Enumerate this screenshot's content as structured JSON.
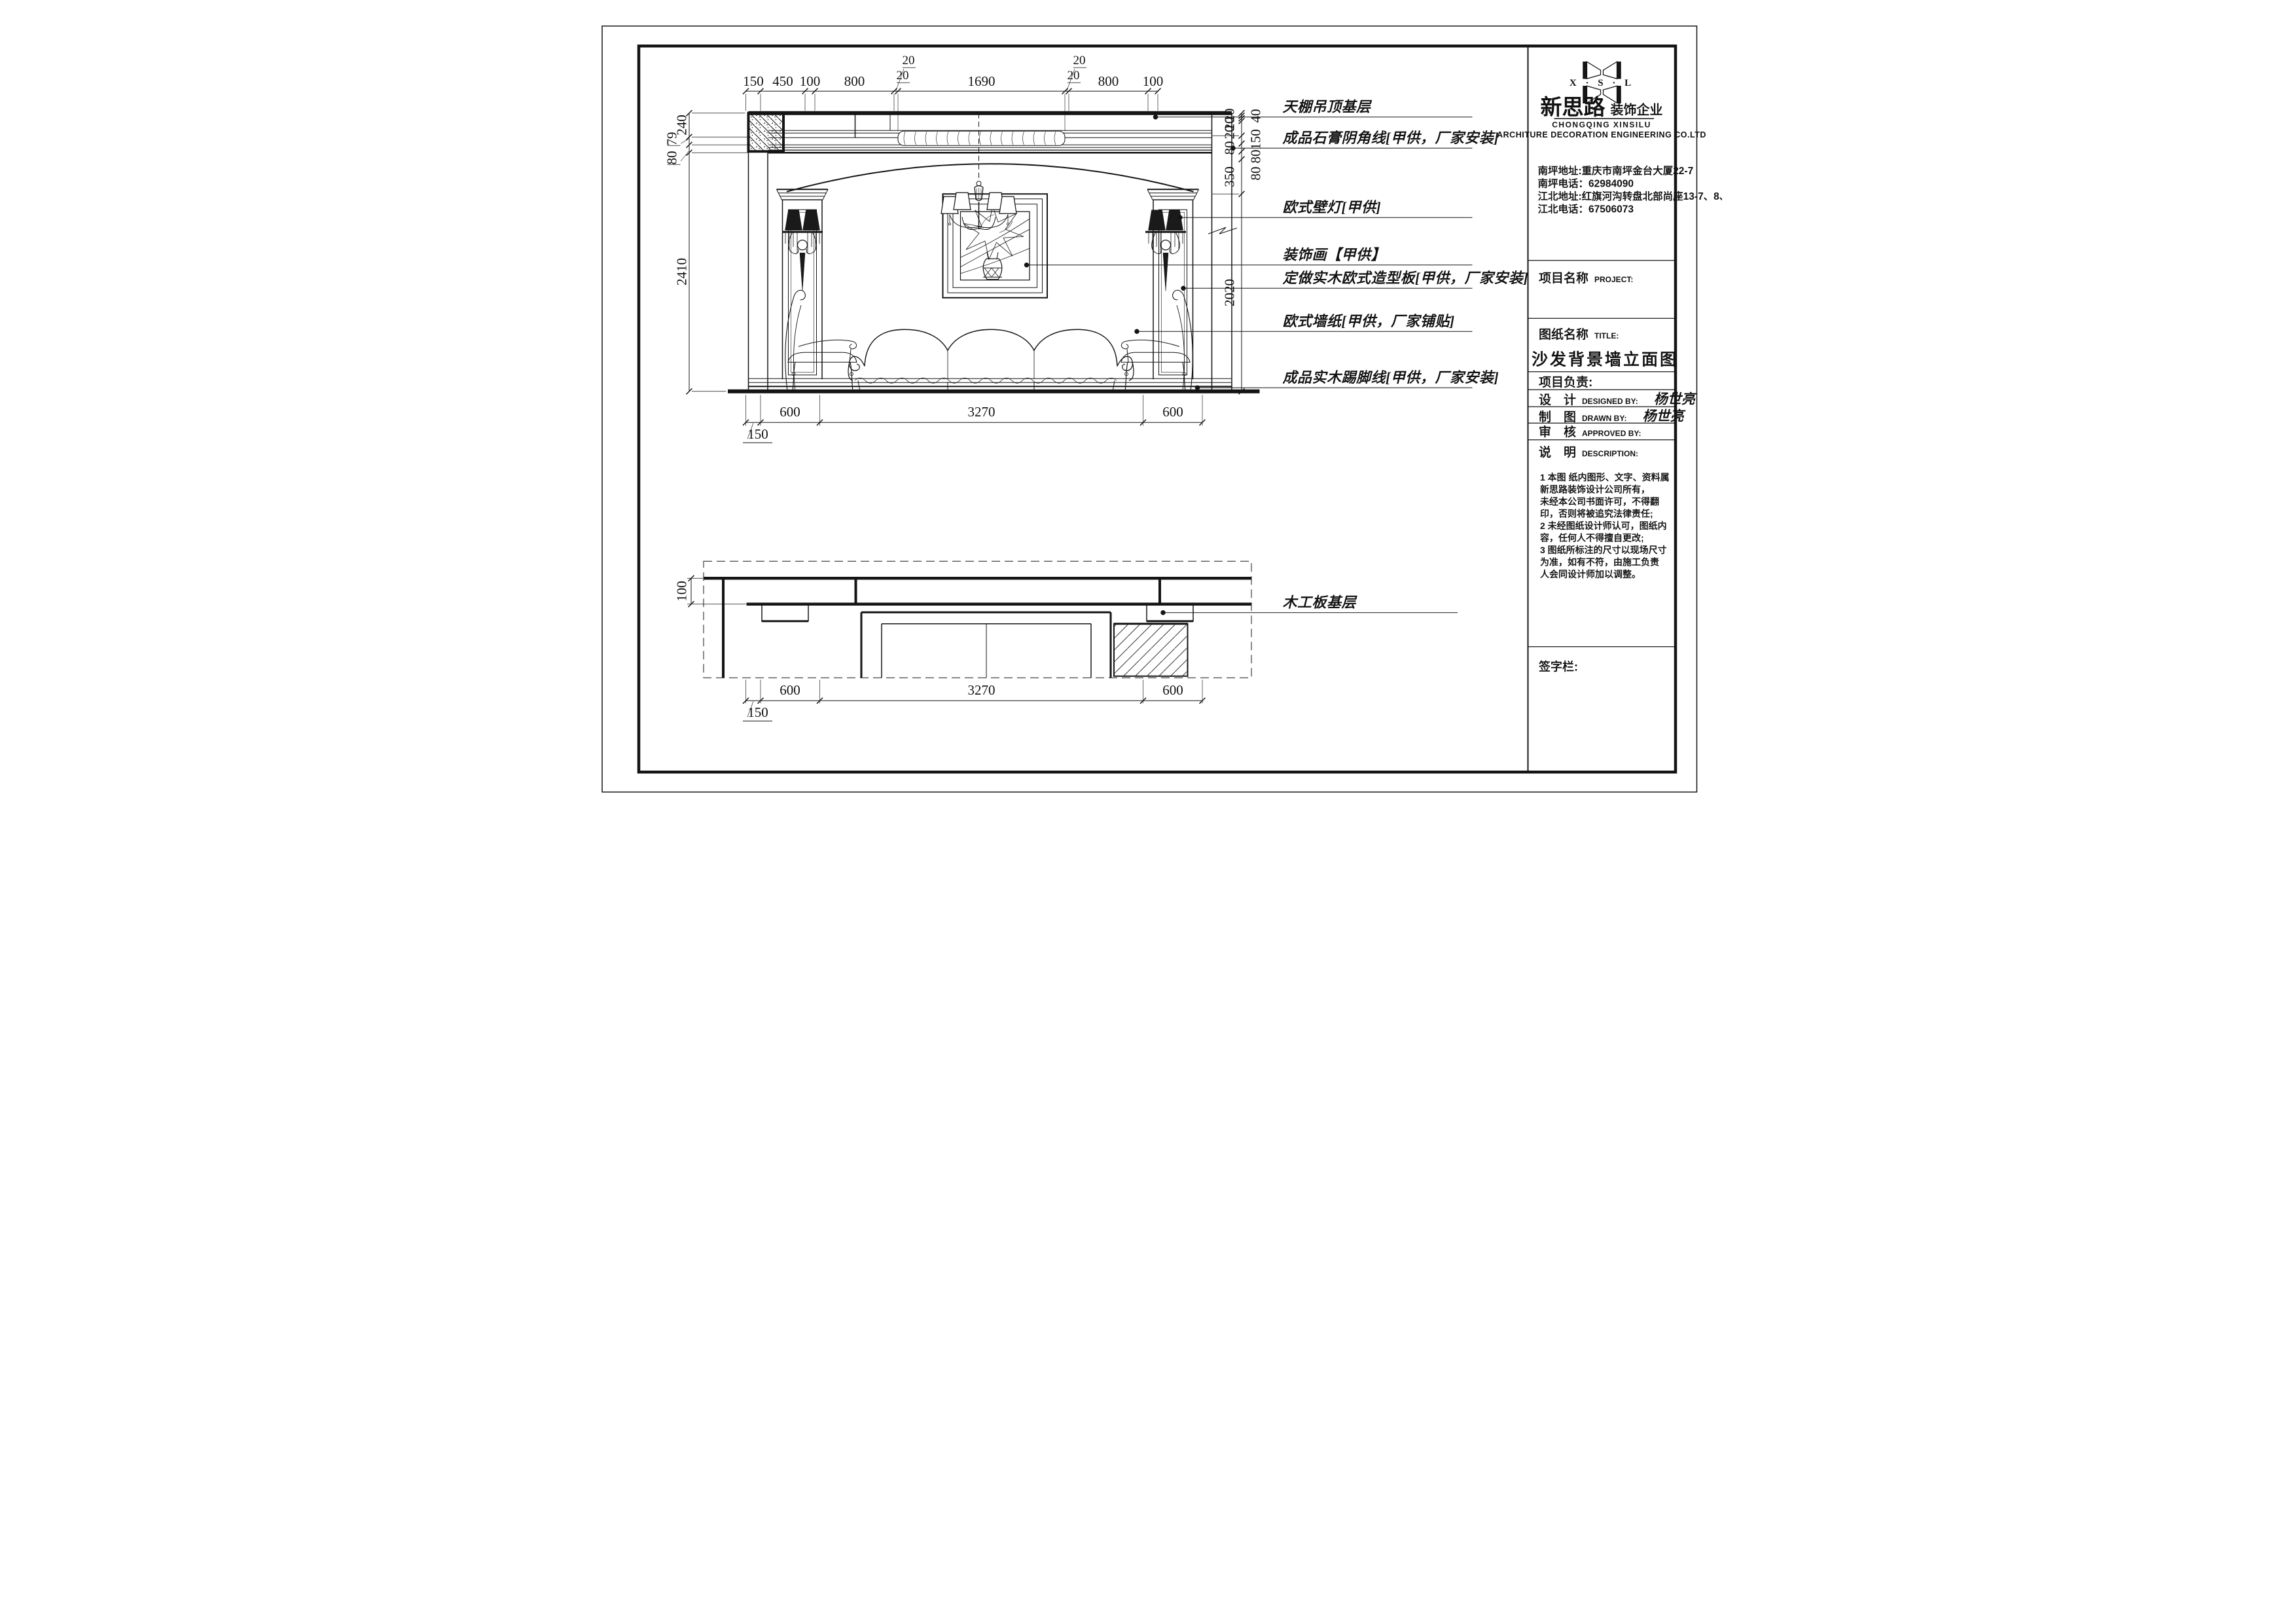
{
  "annotations": {
    "items": [
      {
        "text": "天棚吊顶基层"
      },
      {
        "text": "成品石膏阴角线[甲供，厂家安装]"
      },
      {
        "text": "欧式壁灯[甲供]"
      },
      {
        "text": "装饰画【甲供】"
      },
      {
        "text": "定做实木欧式造型板[甲供，厂家安装]"
      },
      {
        "text": "欧式墙纸[甲供，厂家铺贴]"
      },
      {
        "text": "成品实木踢脚线[甲供，厂家安装]"
      },
      {
        "text": "木工板基层"
      }
    ]
  },
  "dims": {
    "top": [
      "150",
      "450",
      "100",
      "800",
      "1690",
      "800",
      "100"
    ],
    "top_small": [
      "20",
      "20",
      "20",
      "20"
    ],
    "left": [
      "240",
      "79",
      "80",
      "2410"
    ],
    "right_inner": [
      "20",
      "20",
      "20",
      "80",
      "350",
      "2020"
    ],
    "right_outer": [
      "40",
      "150",
      "80",
      "80"
    ],
    "bottom": [
      "600",
      "3270",
      "600"
    ],
    "bottom_offset": "150",
    "plan_bottom": [
      "600",
      "3270",
      "600"
    ],
    "plan_bottom_offset": "150",
    "plan_left": "100"
  },
  "title_block": {
    "logo_text": "X · S · L",
    "company_cn": "新思路",
    "company_suffix": "装饰企业",
    "company_en1": "CHONGQING XINSILU",
    "company_en2": "ARCHITURE DECORATION ENGINEERING CO.LTD",
    "addresses": [
      "南坪地址:重庆市南坪金台大厦22-7",
      "南坪电话：62984090",
      "江北地址:红旗河沟转盘北部尚座13-7、8、9",
      "江北电话：67506073"
    ],
    "project_label": "项目名称",
    "project_en": "PROJECT:",
    "sheet_label": "图纸名称",
    "sheet_en": "TITLE:",
    "drawing_title": "沙发背景墙立面图",
    "pm_label": "项目负责:",
    "design_label": "设　计",
    "design_en": "DESIGNED BY:",
    "designer": "杨世亮",
    "draft_label": "制　图",
    "draft_en": "DRAWN BY:",
    "drafter": "杨世亮",
    "approve_label": "审　核",
    "approve_en": "APPROVED BY:",
    "desc_label": "说　明",
    "desc_en": "DESCRIPTION:",
    "notes": "1 本图 纸内图形、文字、资料属\n   新思路装饰设计公司所有，\n   未经本公司书面许可，不得翻\n   印，否则将被追究法律责任;\n2 未经图纸设计师认可，图纸内\n   容，任何人不得擅自更改;\n3 图纸所标注的尺寸以现场尺寸\n   为准，如有不符，由施工负责\n   人会同设计师加以调整。",
    "signature_label": "签字栏:"
  }
}
